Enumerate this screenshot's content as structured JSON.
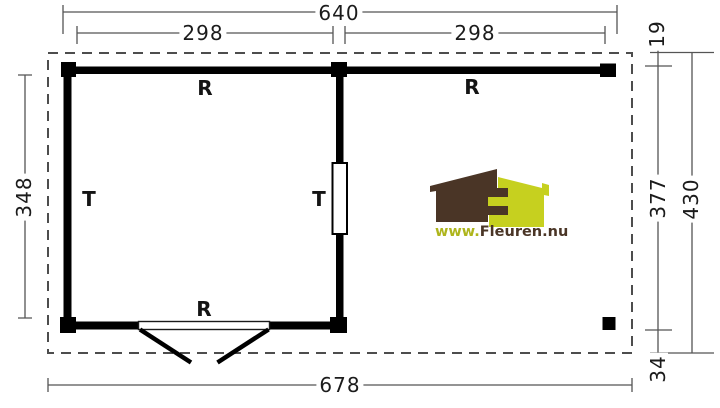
{
  "plan": {
    "title": "floor-plan-log-cabin-with-canopy",
    "dimensions": {
      "top_total": "640",
      "top_left_bay": "298",
      "top_right_bay": "298",
      "right_overhang_top": "19",
      "left_inner_depth": "348",
      "right_canopy_depth": "377",
      "right_total_depth": "430",
      "right_overhang_bottom": "34",
      "bottom_total": "678"
    },
    "wall_labels": {
      "top_left_wall": "R",
      "top_right_beam": "R",
      "bottom_wall": "R",
      "left_wall": "T",
      "middle_wall": "T"
    },
    "logo": {
      "text_prefix": "www.",
      "text_suffix": "Fleuren.nu",
      "colors": {
        "brown": "#4a3526",
        "green": "#c6d01f",
        "text_green": "#aeb51c",
        "text_brown": "#4a3526"
      }
    },
    "drawing_colors": {
      "walls": "#000000",
      "dashed_outline": "#4d4d4d",
      "dimension_lines": "#555555"
    }
  }
}
